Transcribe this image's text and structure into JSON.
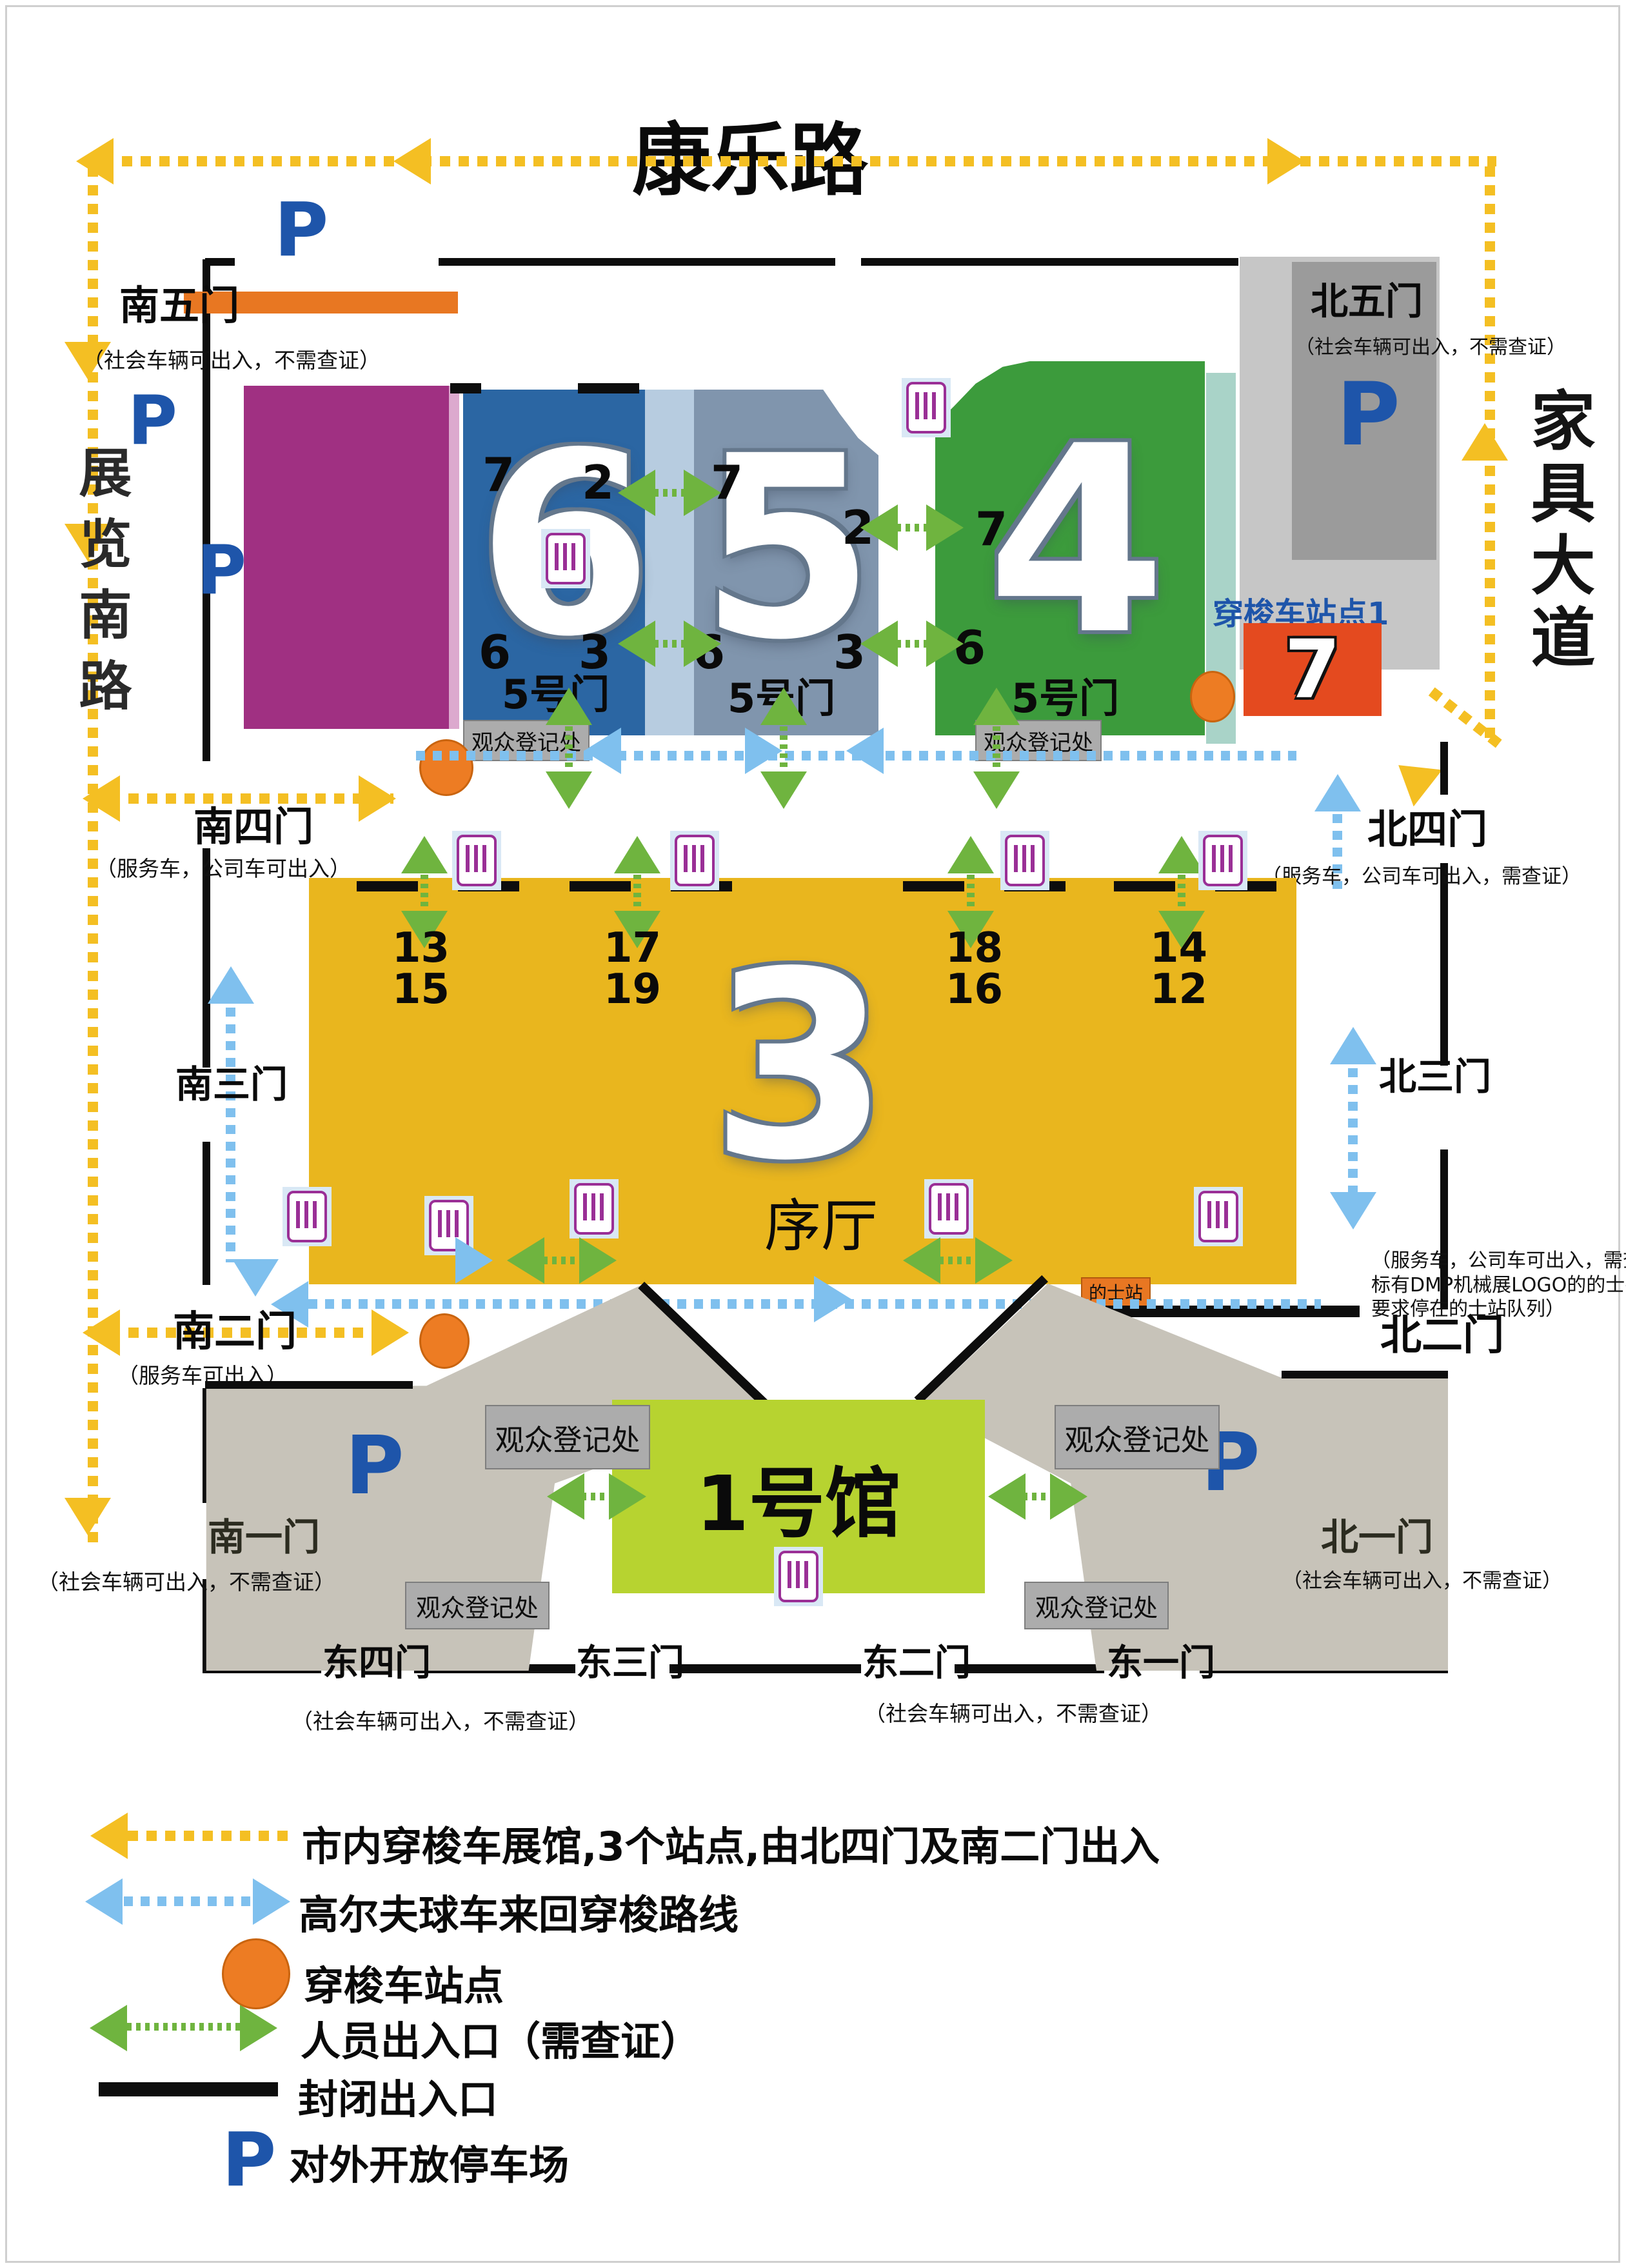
{
  "roads": {
    "top": "康乐路",
    "left": "展览南路",
    "right": "家具大道"
  },
  "p": "P",
  "labels": {
    "shuttle_station1": "穿梭车站点1",
    "taxi_stand": "的士站",
    "registration": "观众登记处",
    "lobby": "序厅",
    "door5": "5号门"
  },
  "halls": {
    "h6": "6",
    "h5": "5",
    "h4": "4",
    "h3": "3",
    "h7": "7",
    "h1": "1号馆"
  },
  "nums": {
    "n7": "7",
    "n2": "2",
    "n6": "6",
    "n3": "3",
    "p1315": "13 15",
    "p1719": "17 19",
    "p1816": "18 16",
    "p1412": "14 12"
  },
  "gates": {
    "south5": {
      "name": "南五门",
      "note": "（社会车辆可出入，不需查证）"
    },
    "south4": {
      "name": "南四门",
      "note": "（服务车，公司车可出入）"
    },
    "south3": {
      "name": "南三门"
    },
    "south2": {
      "name": "南二门",
      "note": "（服务车可出入）"
    },
    "south1": {
      "name": "南一门",
      "note": "（社会车辆可出入，不需查证）"
    },
    "north5": {
      "name": "北五门",
      "note": "（社会车辆可出入，不需查证）"
    },
    "north4": {
      "name": "北四门",
      "note": "（服务车，公司车可出入，需查证）"
    },
    "north3": {
      "name": "北三门"
    },
    "north2": {
      "name": "北二门",
      "note1": "（服务车，公司车可出入，需查证",
      "note2": "标有DMP机械展LOGO的的士有限放入，",
      "note3": "要求停在的士站队列）"
    },
    "north1": {
      "name": "北一门",
      "note": "（社会车辆可出入，不需查证）"
    },
    "east4": {
      "name": "东四门"
    },
    "east3": {
      "name": "东三门"
    },
    "east2": {
      "name": "东二门"
    },
    "east1": {
      "name": "东一门"
    },
    "east_note_left": "（社会车辆可出入，不需查证）",
    "east_note_right": "（社会车辆可出入，不需查证）"
  },
  "legend": {
    "shuttle_route": "市内穿梭车展馆,3个站点,由北四门及南二门出入",
    "golf_route": "高尔夫球车来回穿梭路线",
    "shuttle_station": "穿梭车站点",
    "personnel": "人员出入口（需查证）",
    "closed": "封闭出入口",
    "public_parking": "对外开放停车场"
  },
  "colors": {
    "shuttle_yellow": "#F4BF23",
    "golf_blue": "#7FC0EE",
    "personnel_green": "#6FB43F",
    "station_orange": "#ED7C23",
    "parking_blue": "#1E55AA",
    "hall6": "#2B66A3",
    "hall5": "#8095AD",
    "hall4": "#3C9B3C",
    "hall3": "#E9B61E",
    "hall7": "#E44A1F",
    "hall1": "#B7D330",
    "hall_purple": "#A03082"
  }
}
